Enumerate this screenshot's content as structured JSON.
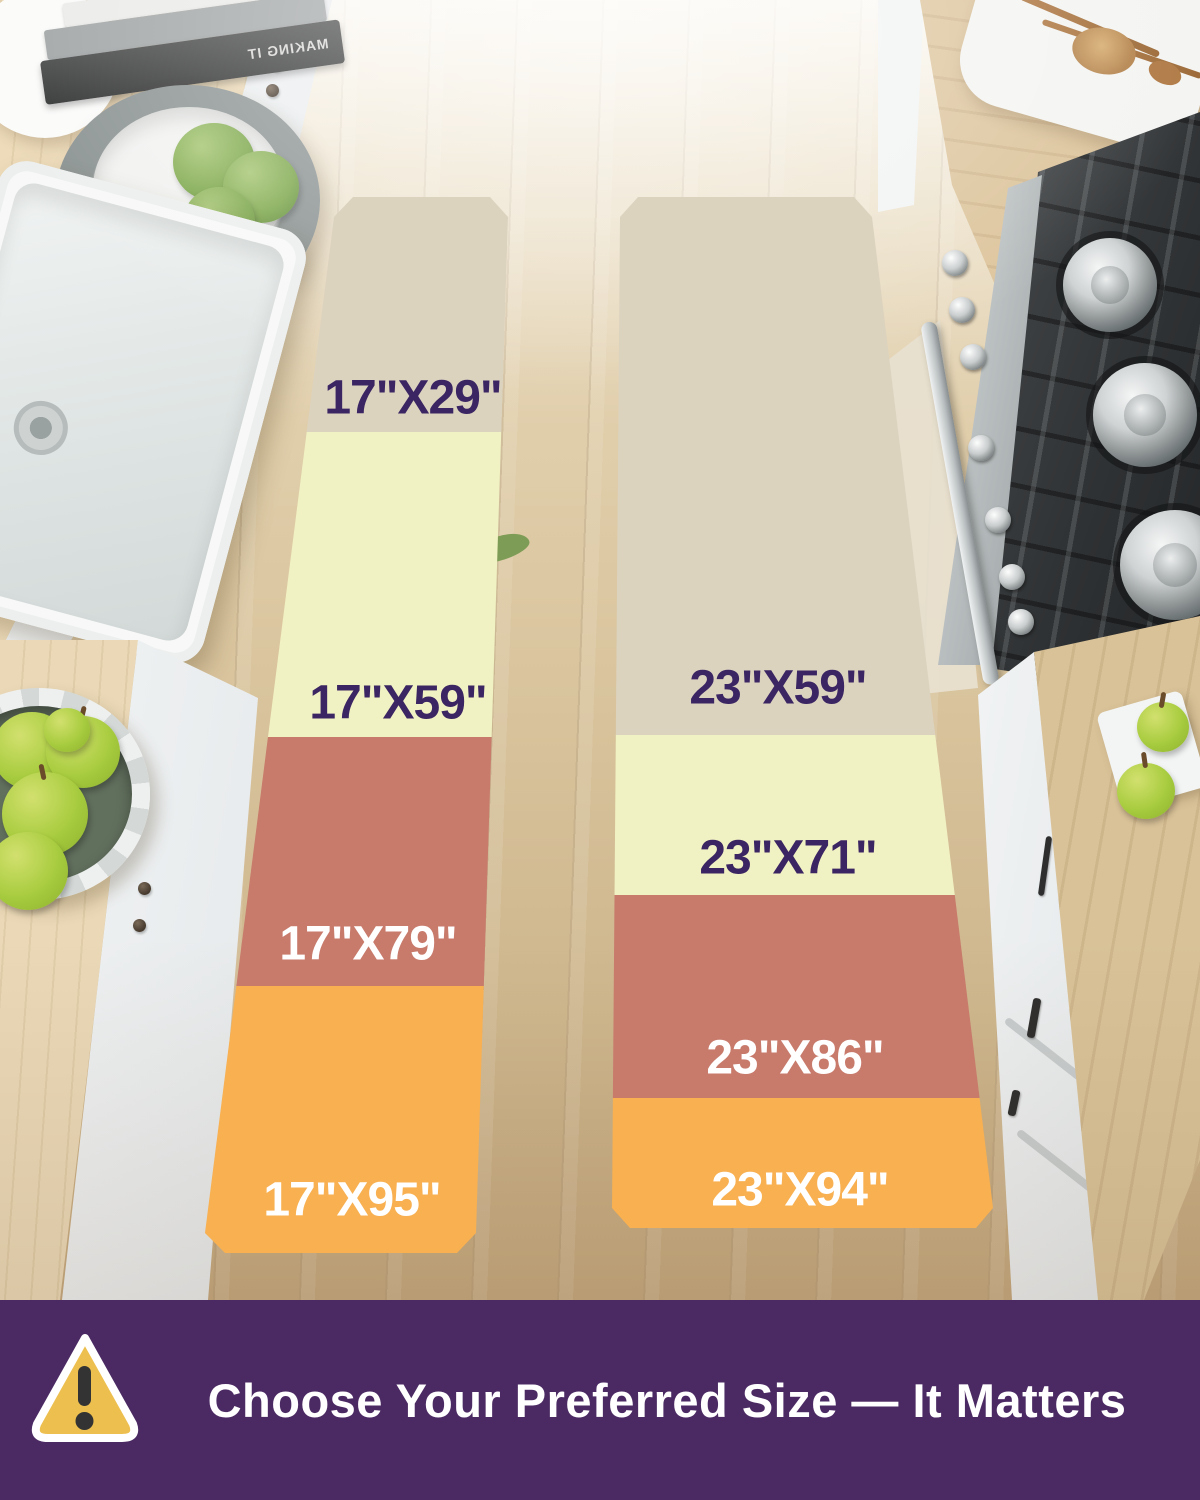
{
  "rugs": {
    "left": {
      "segments": [
        {
          "label": "17\"X29\"",
          "color": "#dcd3bf",
          "label_color": "#3b2562"
        },
        {
          "label": "17\"X59\"",
          "color": "#f1f2c3",
          "label_color": "#3b2562"
        },
        {
          "label": "17\"X79\"",
          "color": "#c87a6b",
          "label_color": "#ffffff"
        },
        {
          "label": "17\"X95\"",
          "color": "#f8b051",
          "label_color": "#ffffff"
        }
      ]
    },
    "right": {
      "segments": [
        {
          "label": "23\"X59\"",
          "color": "#dcd3bf",
          "label_color": "#3b2562"
        },
        {
          "label": "23\"X71\"",
          "color": "#f1f2c3",
          "label_color": "#3b2562"
        },
        {
          "label": "23\"X86\"",
          "color": "#c87a6b",
          "label_color": "#ffffff"
        },
        {
          "label": "23\"X94\"",
          "color": "#f8b051",
          "label_color": "#ffffff"
        }
      ]
    }
  },
  "banner": {
    "text": "Choose Your Preferred Size — It Matters",
    "background": "#4b2a63",
    "text_color": "#ffffff",
    "icon": "warning-triangle-icon",
    "icon_fill": "#edbf4e",
    "icon_stroke": "#ffffff",
    "icon_mark_color": "#333333"
  },
  "scene": {
    "book_title": "MAKING IT"
  }
}
